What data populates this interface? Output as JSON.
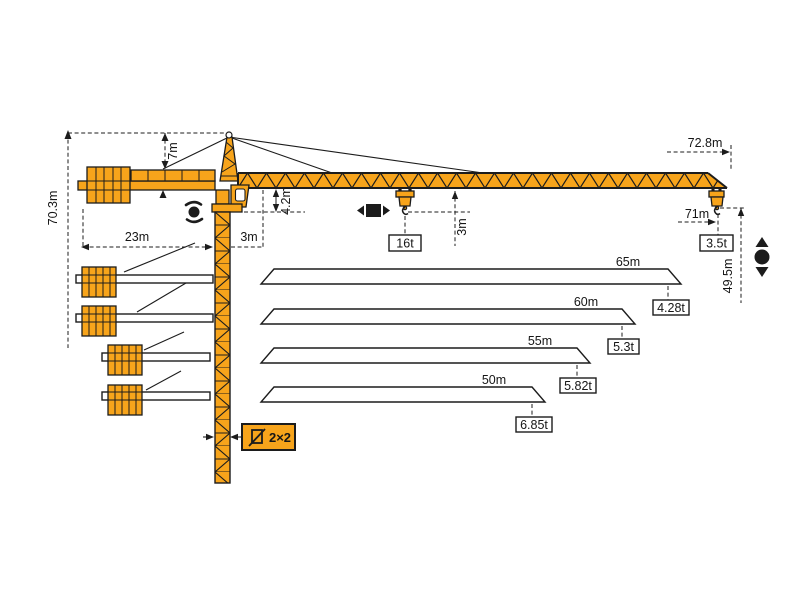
{
  "diagram_title": "Tower crane dimensions and load diagram",
  "colors": {
    "crane_orange": "#F7A41B",
    "outline": "#1C1C1C",
    "background": "#FFFFFF"
  },
  "crane": {
    "total_height": "70.3m",
    "head_height": "7m",
    "counter_jib_radius": "23m",
    "rear_offset": "3m",
    "clearance_under_jib": "4.2m",
    "min_hook_offset": "3m",
    "jib_length_overall": "72.8m",
    "max_radius": "71m",
    "hook_height_at_tip": "49.5m",
    "max_capacity": "16t",
    "tip_capacity": "3.5t",
    "mast_section": "2×2"
  },
  "jib_variants": [
    {
      "length": "65m",
      "tip_capacity": "4.28t"
    },
    {
      "length": "60m",
      "tip_capacity": "5.3t"
    },
    {
      "length": "55m",
      "tip_capacity": "5.82t"
    },
    {
      "length": "50m",
      "tip_capacity": "6.85t"
    }
  ],
  "symbols": {
    "slewing": "slewing-icon",
    "trolley_travel": "trolley-travel-icon",
    "hoisting": "hoisting-icon",
    "mast_section": "mast-cross-section-icon"
  }
}
